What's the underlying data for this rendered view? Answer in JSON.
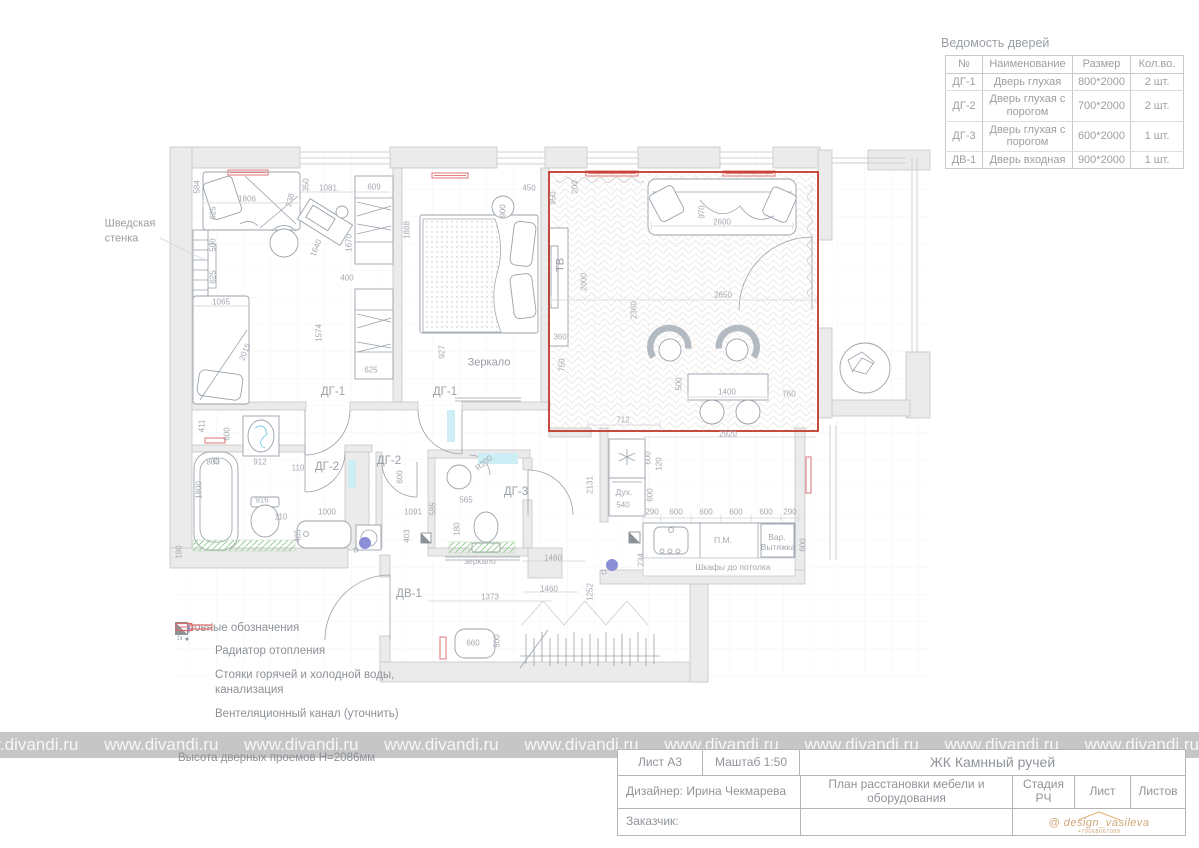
{
  "doors_table": {
    "title": "Ведомость дверей",
    "headers": [
      "№",
      "Наименование",
      "Размер",
      "Кол.во."
    ],
    "rows": [
      {
        "num": "ДГ-1",
        "name": "Дверь глухая",
        "size": "800*2000",
        "qty": "2 шт."
      },
      {
        "num": "ДГ-2",
        "name": "Дверь глухая с порогом",
        "size": "700*2000",
        "qty": "2 шт."
      },
      {
        "num": "ДГ-3",
        "name": "Дверь глухая с порогом",
        "size": "600*2000",
        "qty": "1 шт."
      },
      {
        "num": "ДВ-1",
        "name": "Дверь входная",
        "size": "900*2000",
        "qty": "1 шт."
      }
    ]
  },
  "legend": {
    "title": "Условные обозначения",
    "items": [
      {
        "icon": "radiator",
        "label": "Радиатор отопления"
      },
      {
        "icon": "risers",
        "label": "Стояки горячей и холодной воды, канализация"
      },
      {
        "icon": "vent",
        "label": "Вентеляционный канал (уточнить)"
      },
      {
        "icon": "electric",
        "label": "Электрощит"
      }
    ],
    "note": "Высота дверных проемов Н=2086мм"
  },
  "title_block": {
    "sheet": "Лист А3",
    "scale": "Маштаб 1:50",
    "project": "ЖК Камнный ручей",
    "designer": "Дизайнер: Ирина Чекмарева",
    "drawing_title": "План расстановки мебели и оборудования",
    "stage_label": "Стадия",
    "stage_value": "РЧ",
    "sheet_label": "Лист",
    "sheets_label": "Листов",
    "client": "Заказчик:",
    "logo": "@ design_vasileva",
    "phone": "+79068067089"
  },
  "watermark": "www.divandi.ru",
  "plan": {
    "door_labels": [
      {
        "t": "ДГ-1",
        "x": 333,
        "y": 392
      },
      {
        "t": "ДГ-1",
        "x": 445,
        "y": 392
      },
      {
        "t": "ДГ-2",
        "x": 327,
        "y": 467
      },
      {
        "t": "ДГ-2",
        "x": 389,
        "y": 461
      },
      {
        "t": "ДГ-3",
        "x": 516,
        "y": 492
      },
      {
        "t": "ДВ-1",
        "x": 409,
        "y": 594
      }
    ],
    "room_texts": [
      {
        "t": "Шведская\nстенка",
        "x": 130,
        "y": 232,
        "cls": "big"
      },
      {
        "t": "Зеркало",
        "x": 489,
        "y": 363,
        "cls": "big"
      },
      {
        "t": "ТВ",
        "x": 561,
        "y": 265,
        "cls": "big",
        "r": 90
      },
      {
        "t": "зеркало",
        "x": 480,
        "y": 561,
        "cls": "small"
      },
      {
        "t": "Дух.",
        "x": 624,
        "y": 492,
        "cls": "small"
      },
      {
        "t": "П.М.",
        "x": 723,
        "y": 540,
        "cls": "small"
      },
      {
        "t": "Вар.",
        "x": 777,
        "y": 537,
        "cls": "small"
      },
      {
        "t": "Вытяжка",
        "x": 778,
        "y": 547,
        "cls": "small"
      },
      {
        "t": "Шкафы до потолка",
        "x": 733,
        "y": 567,
        "cls": "small"
      }
    ],
    "dims": [
      {
        "t": "584",
        "x": 197,
        "y": 187,
        "r": 90
      },
      {
        "t": "1806",
        "x": 247,
        "y": 199
      },
      {
        "t": "625",
        "x": 213,
        "y": 213,
        "r": 90
      },
      {
        "t": "500",
        "x": 213,
        "y": 245,
        "r": 90
      },
      {
        "t": "625",
        "x": 213,
        "y": 277,
        "r": 90
      },
      {
        "t": "1065",
        "x": 221,
        "y": 302
      },
      {
        "t": "2015",
        "x": 245,
        "y": 352,
        "r": 68
      },
      {
        "t": "350",
        "x": 306,
        "y": 185,
        "r": 90
      },
      {
        "t": "1081",
        "x": 328,
        "y": 188
      },
      {
        "t": "238",
        "x": 290,
        "y": 200,
        "r": 75
      },
      {
        "t": "609",
        "x": 374,
        "y": 187
      },
      {
        "t": "1640",
        "x": 316,
        "y": 248,
        "r": 68
      },
      {
        "t": "1670",
        "x": 349,
        "y": 243,
        "r": 90
      },
      {
        "t": "400",
        "x": 347,
        "y": 278
      },
      {
        "t": "1574",
        "x": 319,
        "y": 333,
        "r": 90
      },
      {
        "t": "625",
        "x": 371,
        "y": 370
      },
      {
        "t": "1888",
        "x": 407,
        "y": 230,
        "r": 90
      },
      {
        "t": "450",
        "x": 529,
        "y": 188
      },
      {
        "t": "900",
        "x": 503,
        "y": 211,
        "r": 90
      },
      {
        "t": "927",
        "x": 442,
        "y": 352,
        "r": 90
      },
      {
        "t": "950",
        "x": 553,
        "y": 198,
        "r": 90
      },
      {
        "t": "200",
        "x": 575,
        "y": 187,
        "r": 90
      },
      {
        "t": "970",
        "x": 702,
        "y": 212,
        "r": 90
      },
      {
        "t": "2600",
        "x": 722,
        "y": 222
      },
      {
        "t": "2000",
        "x": 584,
        "y": 282,
        "r": 90
      },
      {
        "t": "360",
        "x": 560,
        "y": 337
      },
      {
        "t": "750",
        "x": 562,
        "y": 365,
        "r": 90
      },
      {
        "t": "2360",
        "x": 634,
        "y": 310,
        "r": 90
      },
      {
        "t": "2650",
        "x": 723,
        "y": 295
      },
      {
        "t": "500",
        "x": 679,
        "y": 384,
        "r": 90
      },
      {
        "t": "1400",
        "x": 727,
        "y": 392
      },
      {
        "t": "760",
        "x": 789,
        "y": 394
      },
      {
        "t": "712",
        "x": 623,
        "y": 420
      },
      {
        "t": "2920",
        "x": 728,
        "y": 434
      },
      {
        "t": "600",
        "x": 648,
        "y": 458,
        "r": 90
      },
      {
        "t": "120",
        "x": 659,
        "y": 464,
        "r": 90
      },
      {
        "t": "600",
        "x": 650,
        "y": 495,
        "r": 90
      },
      {
        "t": "540",
        "x": 623,
        "y": 505
      },
      {
        "t": "2131",
        "x": 590,
        "y": 485,
        "r": 90
      },
      {
        "t": "290",
        "x": 652,
        "y": 512
      },
      {
        "t": "600",
        "x": 676,
        "y": 512
      },
      {
        "t": "600",
        "x": 706,
        "y": 512
      },
      {
        "t": "600",
        "x": 736,
        "y": 512
      },
      {
        "t": "600",
        "x": 766,
        "y": 512
      },
      {
        "t": "290",
        "x": 790,
        "y": 512
      },
      {
        "t": "600",
        "x": 803,
        "y": 545,
        "r": 90
      },
      {
        "t": "234",
        "x": 641,
        "y": 560,
        "r": 90
      },
      {
        "t": "411",
        "x": 202,
        "y": 426,
        "r": 90
      },
      {
        "t": "600",
        "x": 227,
        "y": 434,
        "r": 90
      },
      {
        "t": "800",
        "x": 213,
        "y": 462
      },
      {
        "t": "1800",
        "x": 199,
        "y": 490,
        "r": 90
      },
      {
        "t": "912",
        "x": 260,
        "y": 462
      },
      {
        "t": "110",
        "x": 298,
        "y": 468
      },
      {
        "t": "916",
        "x": 262,
        "y": 500
      },
      {
        "t": "110",
        "x": 281,
        "y": 517
      },
      {
        "t": "1000",
        "x": 327,
        "y": 512
      },
      {
        "t": "485",
        "x": 298,
        "y": 536,
        "r": 90
      },
      {
        "t": "600",
        "x": 400,
        "y": 477,
        "r": 90
      },
      {
        "t": "1091",
        "x": 413,
        "y": 512
      },
      {
        "t": "585",
        "x": 433,
        "y": 509,
        "r": 90
      },
      {
        "t": "403",
        "x": 407,
        "y": 536,
        "r": 90
      },
      {
        "t": "565",
        "x": 466,
        "y": 500
      },
      {
        "t": "180",
        "x": 457,
        "y": 529,
        "r": 90
      },
      {
        "t": "R200",
        "x": 484,
        "y": 463,
        "r": 40
      },
      {
        "t": "180",
        "x": 179,
        "y": 552,
        "r": 90
      },
      {
        "t": "1460",
        "x": 553,
        "y": 558
      },
      {
        "t": "1460",
        "x": 549,
        "y": 589
      },
      {
        "t": "1252",
        "x": 590,
        "y": 592,
        "r": 90
      },
      {
        "t": "1373",
        "x": 490,
        "y": 597
      },
      {
        "t": "660",
        "x": 473,
        "y": 643
      },
      {
        "t": "500",
        "x": 497,
        "y": 641,
        "r": 90
      }
    ]
  }
}
